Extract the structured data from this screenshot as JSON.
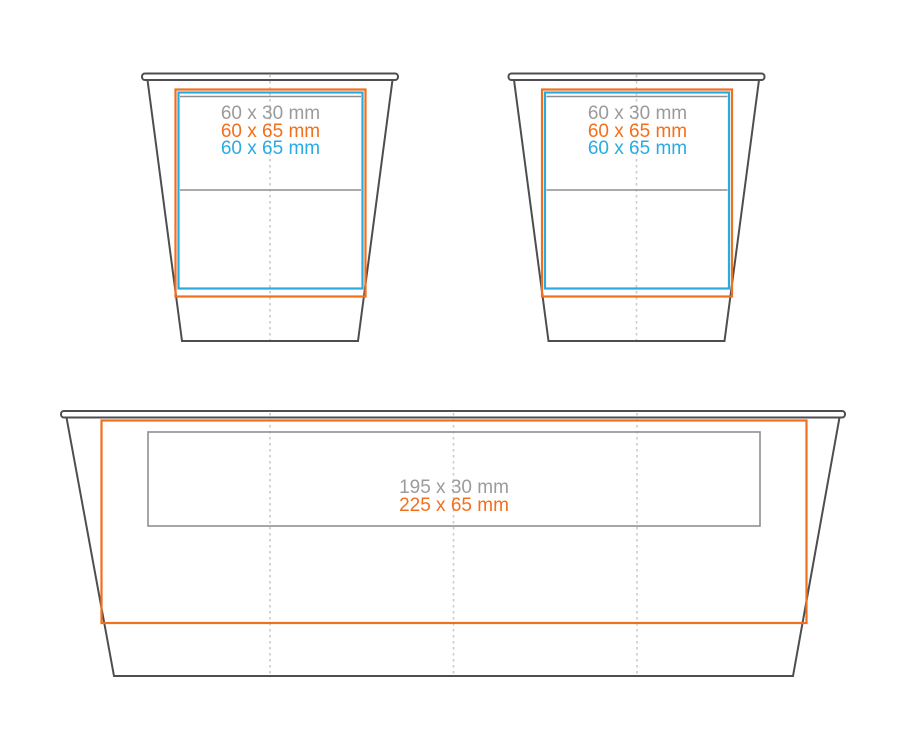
{
  "colors": {
    "background": "#FFFFFF",
    "outline": "#4E4E50",
    "accent_orange": "#F26F1D",
    "accent_blue": "#29ABE2",
    "line_gray": "#8F8F91",
    "label_gray": "#9B9B9B",
    "fold_dotted": "#CBCBCB"
  },
  "cup_left": {
    "labels": [
      {
        "text": "60 x 30 mm"
      },
      {
        "text": "60 x 65 mm"
      },
      {
        "text": "60 x 65 mm"
      }
    ]
  },
  "cup_right": {
    "labels": [
      {
        "text": "60 x 30 mm"
      },
      {
        "text": "60 x 65 mm"
      },
      {
        "text": "60 x 65 mm"
      }
    ]
  },
  "planter": {
    "labels": [
      {
        "text": "195 x 30 mm"
      },
      {
        "text": "225 x 65 mm"
      }
    ]
  }
}
